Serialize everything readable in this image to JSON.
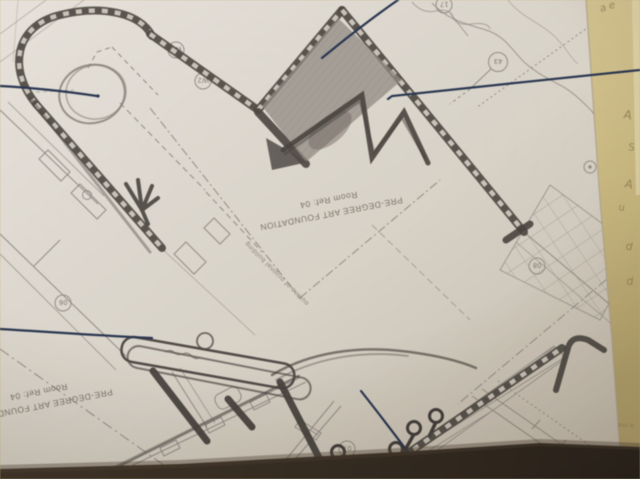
{
  "plan_labels": {
    "room_tag_center": {
      "line1": "PRE-DEGREE ART FOUNDATION",
      "line2": "Room Ref: 04"
    },
    "room_tag_bottom_left": {
      "line1": "PRE-DEGREE ART FOUNDATION",
      "line2": "Room Ref: 04"
    },
    "pencil_note": "outline of original building",
    "balloons": {
      "w1": "W1",
      "w2": "W2",
      "b43": "43",
      "b17": "17",
      "b08": "08",
      "b07": "07",
      "b06": "06"
    }
  },
  "handwriting": {
    "top": "a e",
    "col1": "A",
    "col2": "S",
    "col3": "A",
    "col4": "u",
    "col5": "d",
    "col6": "d",
    "bottom_note": "pos w"
  },
  "colors": {
    "backing_paper": "#d2c28c",
    "sheet": "#ddd9d2",
    "print_line": "#8d8a86",
    "pencil": "#3f3c3a",
    "ink_pen": "#20304f",
    "shadow_band": "#2e2620"
  }
}
